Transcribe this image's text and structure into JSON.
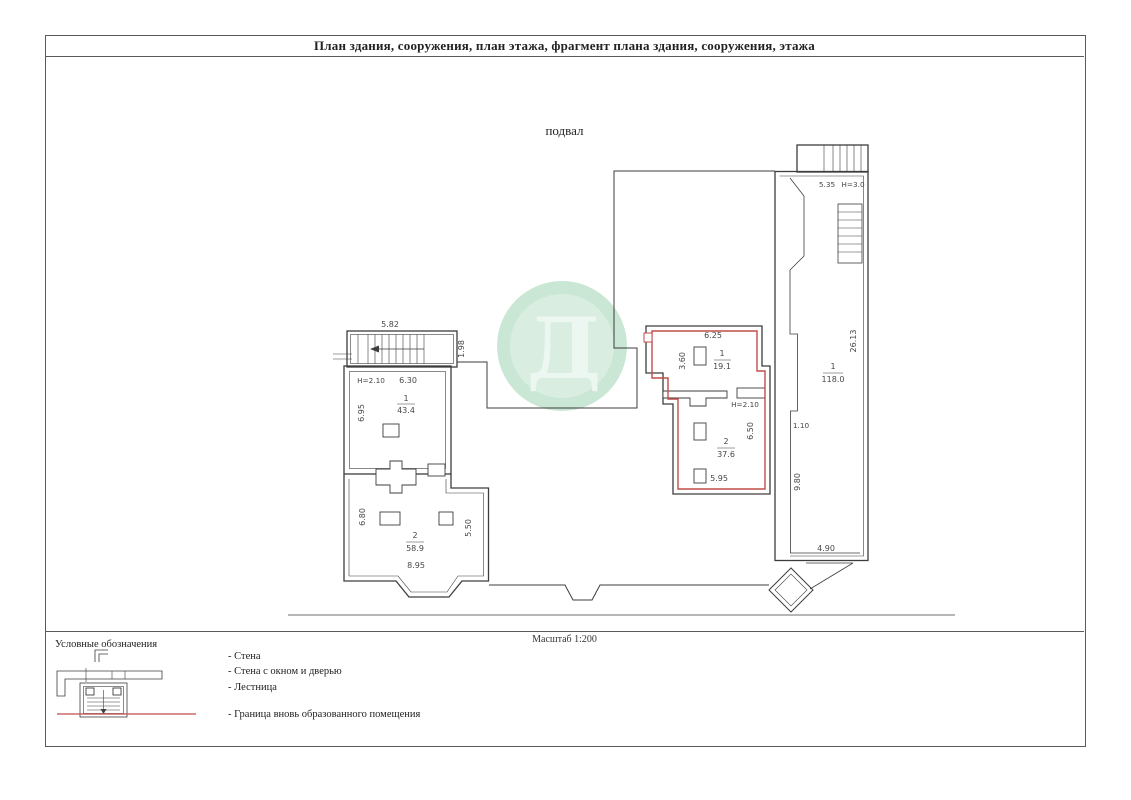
{
  "page": {
    "title": "План здания, сооружения, план этажа, фрагмент плана здания, сооружения, этажа",
    "floor_label": "подвал",
    "scale_label": "Масштаб 1:200"
  },
  "colors": {
    "boundary_red": "#bf4e49",
    "line_ink": "#3d3d3d",
    "watermark_green": "#c9e7d4"
  },
  "watermark": {
    "letter": "Д"
  },
  "plan": {
    "left_building": {
      "stairs_width": "5.82",
      "stairs_depth": "1.98",
      "height_label": "Н=2.10",
      "width_top": "6.30",
      "depth_left_top": "6.95",
      "room1": {
        "number": "1",
        "area": "43.4"
      },
      "depth_left_bottom": "6.80",
      "room2": {
        "number": "2",
        "area": "58.9"
      },
      "depth_right_bottom": "5.50",
      "width_bottom": "8.95"
    },
    "middle_building": {
      "width_top": "6.25",
      "depth_entry": "3.60",
      "room1": {
        "number": "1",
        "area": "19.1"
      },
      "height_label": "Н=2.10",
      "depth_right": "6.50",
      "room2": {
        "number": "2",
        "area": "37.6"
      },
      "width_bottom": "5.95"
    },
    "right_building": {
      "width_top": "5.35",
      "height_label": "Н=3.0",
      "depth_right": "26.13",
      "room1": {
        "number": "1",
        "area": "118.0"
      },
      "offset": "1.10",
      "depth_left": "9.80",
      "width_bottom": "4.90"
    }
  },
  "legend": {
    "header": "Условные обозначения",
    "items": [
      {
        "label": "- Стена"
      },
      {
        "label": "- Стена с окном и дверью"
      },
      {
        "label": "- Лестница"
      },
      {
        "label": "- Граница вновь образованного помещения"
      }
    ]
  }
}
